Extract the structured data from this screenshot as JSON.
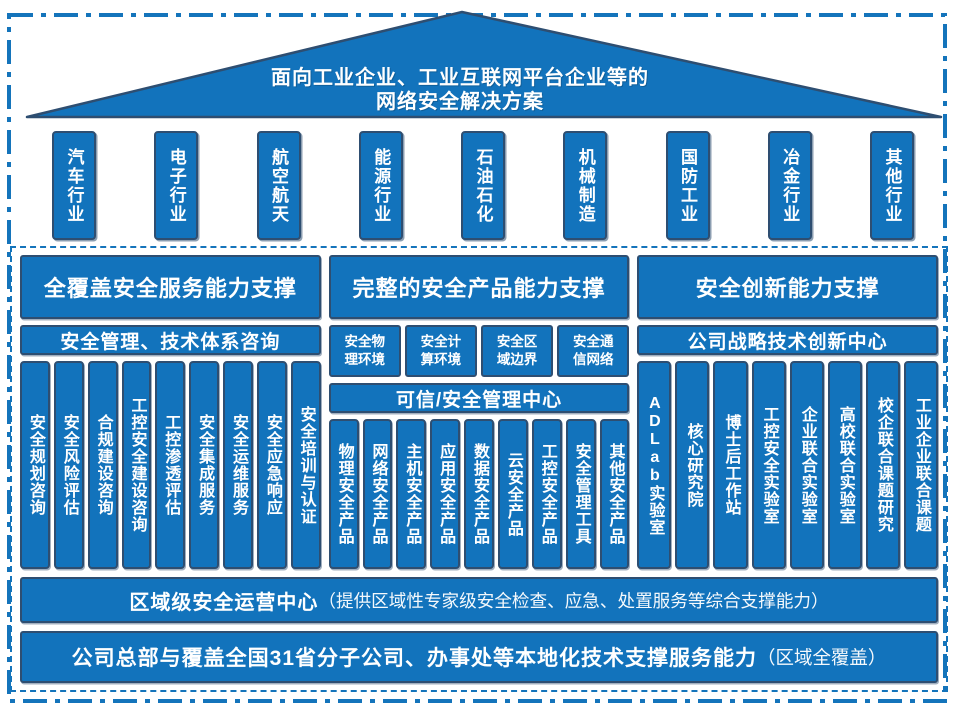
{
  "roof": {
    "title_line1": "面向工业企业、工业互联网平台企业等的",
    "title_line2": "网络安全解决方案"
  },
  "pillars": [
    "汽车行业",
    "电子行业",
    "航空航天",
    "能源行业",
    "石油石化",
    "机械制造",
    "国防工业",
    "冶金行业",
    "其他行业"
  ],
  "columns": [
    {
      "header": "全覆盖安全服务能力支撑",
      "subbar": "安全管理、技术体系咨询",
      "items": [
        "安全规划咨询",
        "安全风险评估",
        "合规建设咨询",
        "工控安全建设咨询",
        "工控渗透评估",
        "安全集成服务",
        "安全运维服务",
        "安全应急响应",
        "安全培训与认证"
      ]
    },
    {
      "header": "完整的安全产品能力支撑",
      "boxes": [
        "安全物\n理环境",
        "安全计\n算环境",
        "安全区\n域边界",
        "安全通\n信网络"
      ],
      "subbar": "可信/安全管理中心",
      "items": [
        "物理安全产品",
        "网络安全产品",
        "主机安全产品",
        "应用安全产品",
        "数据安全产品",
        "云安全产品",
        "工控安全产品",
        "安全管理工具",
        "其他安全产品"
      ]
    },
    {
      "header": "安全创新能力支撑",
      "subbar": "公司战略技术创新中心",
      "items": [
        "ADLab实验室",
        "核心研究院",
        "博士后工作站",
        "工控安全实验室",
        "企业联合实验室",
        "高校联合实验室",
        "校企联合课题研究",
        "工业企业联合课题"
      ]
    }
  ],
  "bottom_bars": [
    {
      "bold": "区域级安全运营中心",
      "normal": "（提供区域性专家级安全检查、应急、处置服务等综合支撑能力）"
    },
    {
      "bold": "公司总部与覆盖全国31省分子公司、办事处等本地化技术支撑服务能力",
      "normal": "（区域全覆盖）"
    }
  ],
  "colors": {
    "fill": "#1273bc",
    "outline": "#2e4e71",
    "dash": "#1474bb",
    "text": "#ffffff"
  }
}
